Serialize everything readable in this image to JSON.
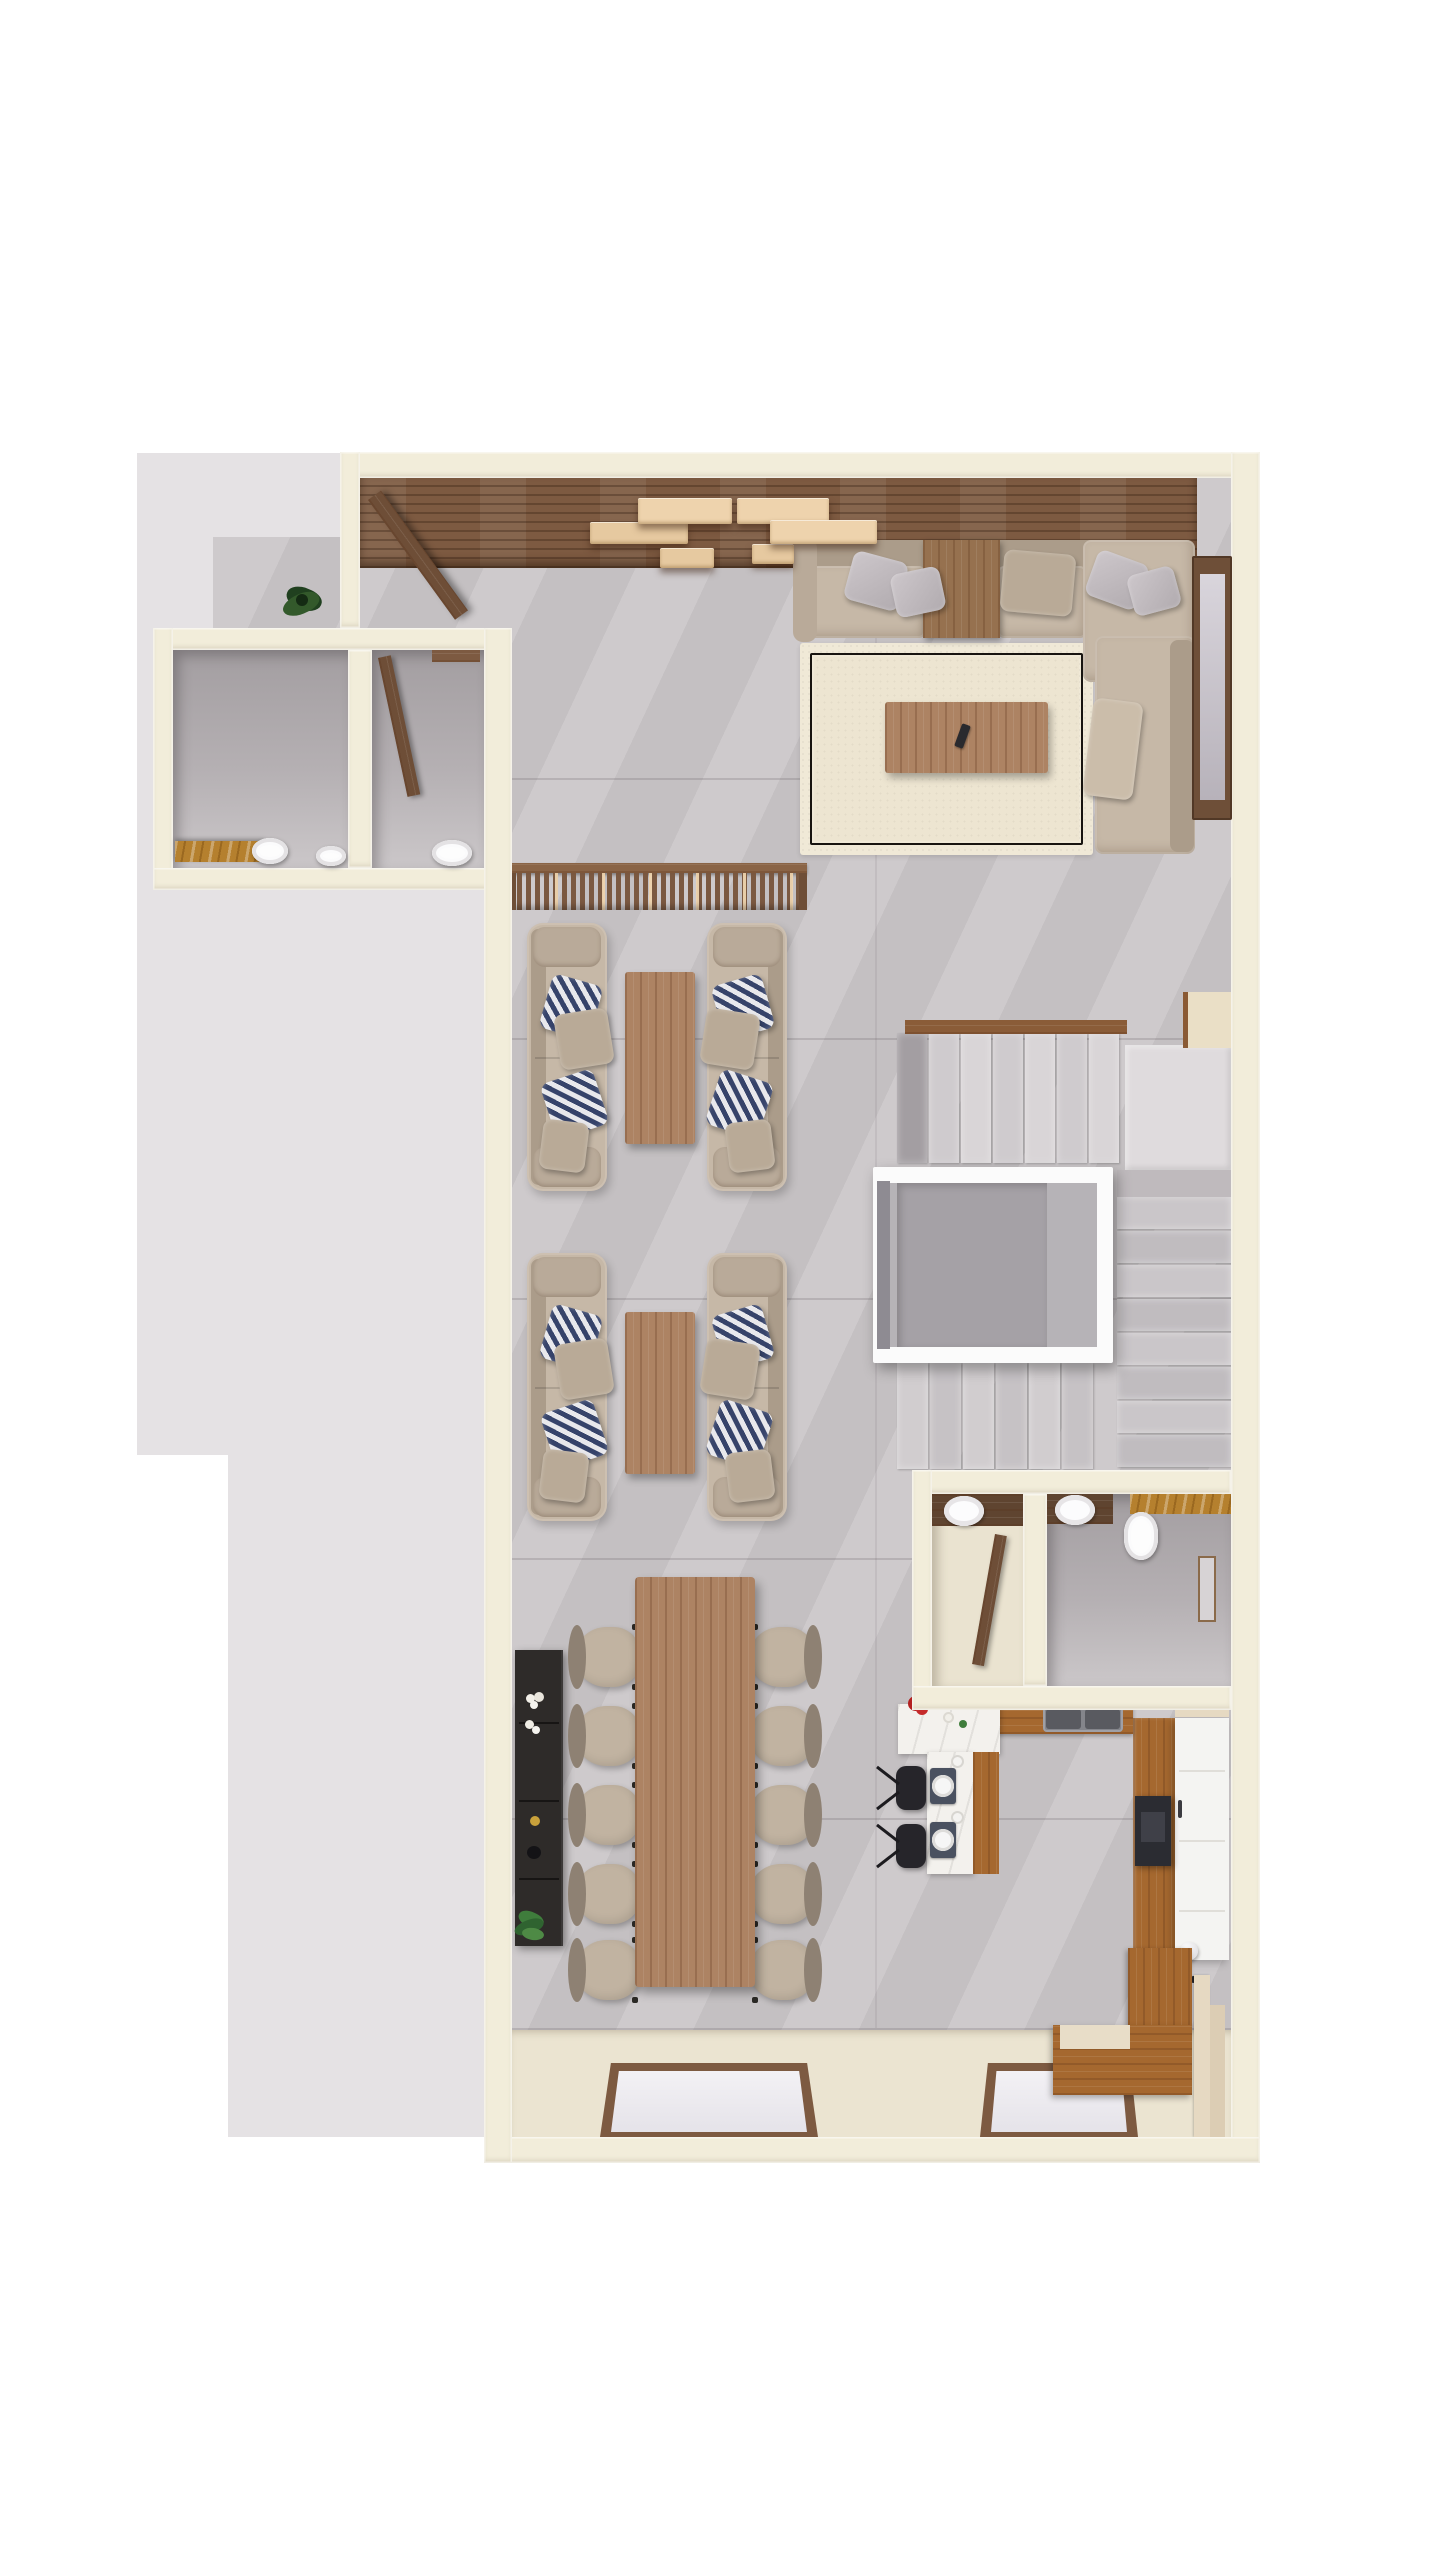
{
  "meta": {
    "type": "3d-floor-plan-top-down-render",
    "description": "Photorealistic top-down 3D render of an apartment level: entry porch, two guest WCs, living room with L-sectional and rug, wood accent wall with floating shelves, two facing lounge sofa groups, U-shaped staircase around an elevator, powder room and bathroom, 10-seat dining table with sideboard, kitchen with breakfast bar and island, floor-to-ceiling windows at the bottom wall.",
    "visible_text": []
  },
  "canvas": {
    "w": 1440,
    "h": 2560,
    "bg": "#ffffff"
  },
  "palette": {
    "exterior": "#e5e2e4",
    "tile": "#cbc7c9",
    "wall": "#f2edda",
    "wallEdge": "#f9f5e8",
    "creamFloor": "#ebe4d1",
    "wood": "#7d5a41",
    "woodLight": "#ad8363",
    "woodMid": "#96714f",
    "oak": "#a5682f",
    "walnutDark": "#5f4430",
    "shelfCream1": "#eed3ad",
    "shelfCream2": "#e6c9a0",
    "sofa": "#c6b8a7",
    "sofaDark": "#ab9c8a",
    "sofaEdge": "#b9aa99",
    "navy": "#36436a",
    "rug": "#f0e9d7",
    "rugField": "#ede5d1",
    "rugLine": "#181410",
    "stairFirst": "#a39ea2",
    "stairLand": "#dfdbdd",
    "elevFrame": "#fbfbfb",
    "elevCab": "#b6b3b7",
    "elevBack": "#a5a1a6",
    "marble": "#f3f1ed",
    "amber": "#b5802e",
    "chairSeat": "#c1b3a1",
    "chairBack": "#8e8173",
    "steel": "#84858b",
    "steelDark": "#595a60",
    "dark": "#2c2b2f",
    "sideboard": "#2e2b29",
    "red": "#b32020",
    "green": "#3f7d3c",
    "white": "#ffffff"
  },
  "inventory": [
    "entry-porch-plant",
    "entry-door-open",
    "wood-accent-wall",
    "floating-shelves",
    "guest-wc-1-toilet",
    "guest-wc-1-vanity",
    "guest-wc-2-toilet",
    "guest-wc-2-door",
    "sectional-sofa",
    "sofa-pillows",
    "area-rug",
    "living-coffee-table",
    "tv-remote",
    "side-window",
    "slatted-wood-divider",
    "lounge-sofa-x4",
    "chevron-pillows",
    "lounge-coffee-table-x2",
    "staircase-upper-flight",
    "stair-landing",
    "staircase-right-flight",
    "staircase-lower-flight",
    "elevator",
    "powder-room-basin",
    "powder-room-door",
    "bathroom-basin",
    "bathroom-toilet",
    "amber-marble-counter",
    "wall-niche",
    "dining-sideboard",
    "sideboard-decor",
    "dining-table",
    "dining-chair-x10",
    "kitchen-sink-double",
    "breakfast-bar",
    "red-flowers",
    "place-setting-x2",
    "bar-stool-x2",
    "kitchen-island",
    "dark-appliance",
    "wood-walkway",
    "corner-wood-cabinet",
    "bottom-window-x2"
  ],
  "generators": {
    "shelves": [
      {
        "x": 590,
        "y": 522,
        "w": 98,
        "h": 22,
        "tone": 2
      },
      {
        "x": 638,
        "y": 498,
        "w": 94,
        "h": 26,
        "tone": 1
      },
      {
        "x": 660,
        "y": 548,
        "w": 54,
        "h": 20,
        "tone": 2
      },
      {
        "x": 737,
        "y": 498,
        "w": 92,
        "h": 26,
        "tone": 1
      },
      {
        "x": 752,
        "y": 544,
        "w": 42,
        "h": 20,
        "tone": 2
      },
      {
        "x": 770,
        "y": 520,
        "w": 107,
        "h": 24,
        "tone": 1
      }
    ],
    "flights": [
      {
        "name": "stairs-upper-flight",
        "x": 897,
        "y": 1033,
        "axis": "x",
        "count": 7,
        "size": 30,
        "gap": 2,
        "length": 130,
        "first_dark": true,
        "tones": [
          "#d9d5d7",
          "#cfcbce"
        ]
      },
      {
        "name": "stairs-right-flight",
        "x": 1117,
        "y": 1197,
        "axis": "y",
        "count": 8,
        "size": 32,
        "gap": 2,
        "length": 114,
        "first_dark": false,
        "tones": [
          "#cac6c9",
          "#c0bcbf"
        ]
      },
      {
        "name": "stairs-lower-flight",
        "x": 897,
        "y": 1363,
        "axis": "x",
        "count": 6,
        "size": 31,
        "gap": 2,
        "length": 106,
        "first_dark": false,
        "tones": [
          "#d1cdcf",
          "#c6c2c5"
        ]
      }
    ],
    "dining_chairs": {
      "left_x": 575,
      "right_x": 749,
      "w": 66,
      "h": 60,
      "centers_y": [
        1657,
        1736,
        1815,
        1894,
        1970
      ]
    },
    "lounge_sofas": [
      {
        "x": 527,
        "y": 923,
        "mirror": false
      },
      {
        "x": 707,
        "y": 923,
        "mirror": true
      },
      {
        "x": 527,
        "y": 1253,
        "mirror": false
      },
      {
        "x": 707,
        "y": 1253,
        "mirror": true
      }
    ],
    "lounge_pillows": [
      {
        "x": 18,
        "y": 56,
        "w": 52,
        "h": 56,
        "rot": 16,
        "type": "chevron"
      },
      {
        "x": 30,
        "y": 88,
        "w": 54,
        "h": 56,
        "rot": -9,
        "type": "plain"
      },
      {
        "x": 20,
        "y": 152,
        "w": 55,
        "h": 58,
        "rot": -18,
        "type": "chevron"
      },
      {
        "x": 14,
        "y": 198,
        "w": 46,
        "h": 50,
        "rot": 7,
        "type": "plain"
      }
    ],
    "floor_seams": {
      "x": 512,
      "w": 719,
      "ys": [
        778,
        1038,
        1298,
        1558,
        1818,
        2028
      ]
    }
  }
}
